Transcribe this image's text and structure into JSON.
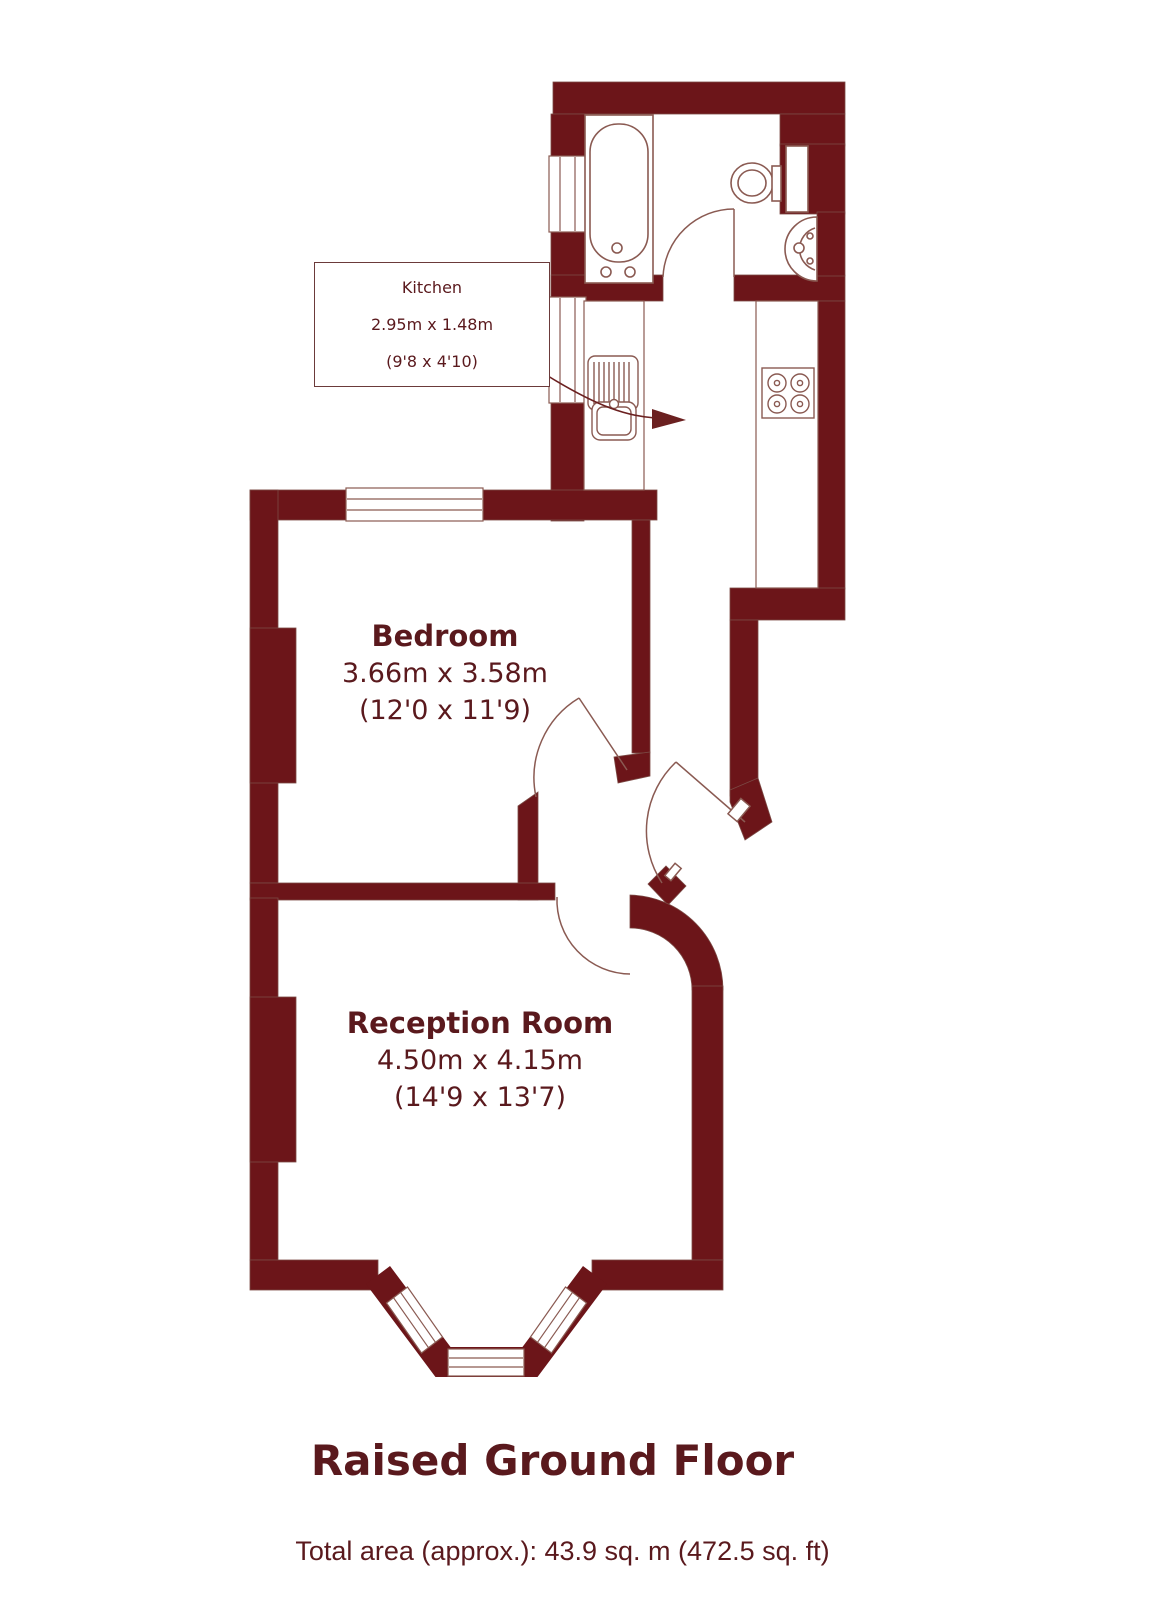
{
  "plan": {
    "rooms": [
      {
        "name": "Kitchen",
        "dims_metric": "2.95m x 1.48m",
        "dims_imperial": "(9'8 x 4'10)"
      },
      {
        "name": "Bedroom",
        "dims_metric": "3.66m x 3.58m",
        "dims_imperial": "(12'0 x 11'9)"
      },
      {
        "name": "Reception Room",
        "dims_metric": "4.50m x 4.15m",
        "dims_imperial": "(14'9 x 13'7)"
      }
    ],
    "fixtures": [
      "bathtub",
      "toilet",
      "wash-basin",
      "kitchen-sink",
      "hob"
    ],
    "colors": {
      "wall": "#6C1519",
      "label_text": "#5A191D",
      "fixture_outline": "#8A5A52"
    }
  },
  "title": "Raised Ground Floor",
  "footer": "Total area (approx.): 43.9 sq. m (472.5 sq. ft)"
}
